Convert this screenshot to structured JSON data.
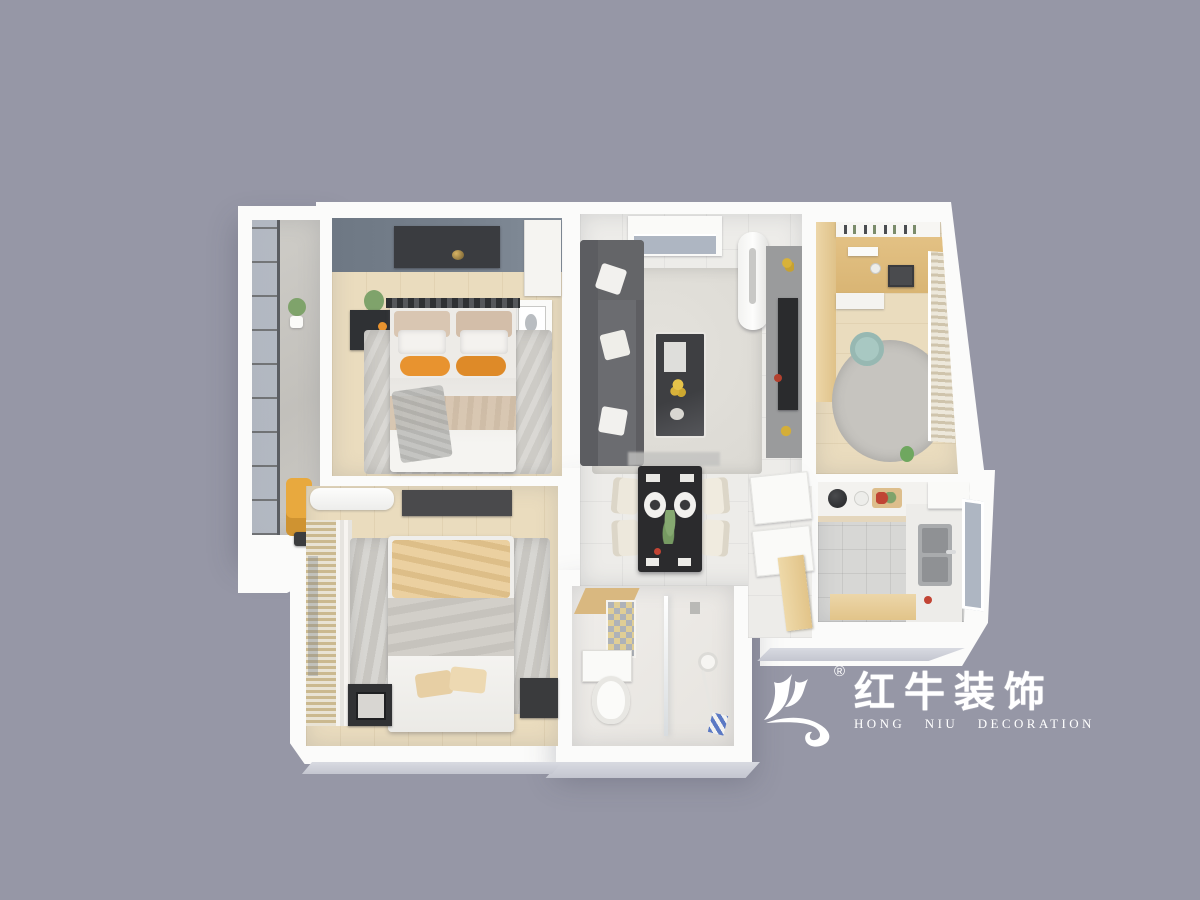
{
  "scene": {
    "type": "3d-floorplan-render",
    "description_visible": false
  },
  "logo": {
    "icon": "hongniu-bull-logo-icon",
    "registered_mark": "®",
    "name_cn": "红牛装饰",
    "name_en": "HONG NIU DECORATION",
    "color": "#FFFFFF"
  },
  "palette": {
    "background": "#9697A6",
    "wall_white": "#FBFBFA",
    "wall_face_shadow": "#C9CBD4",
    "floor_wood_light": "#EADCBE",
    "floor_tile_light": "#EDECE9",
    "floor_tile_gray": "#D7D7D5",
    "rug_gray": "#CDCBC6",
    "bedroom_accent_wall": "#76808C",
    "sofa_gray": "#6B6C70",
    "accent_orange": "#E8932F",
    "accent_yellow_chair": "#E8A93E",
    "beige_blanket": "#EBD0A0",
    "table_black": "#2B2B2D",
    "wood_cabinet": "#E2C489",
    "chair_teal": "#A8C8C2",
    "plant_green": "#7FA36B",
    "glass_blue": "#AEB6C2",
    "chair_cream": "#EDE8DC"
  }
}
